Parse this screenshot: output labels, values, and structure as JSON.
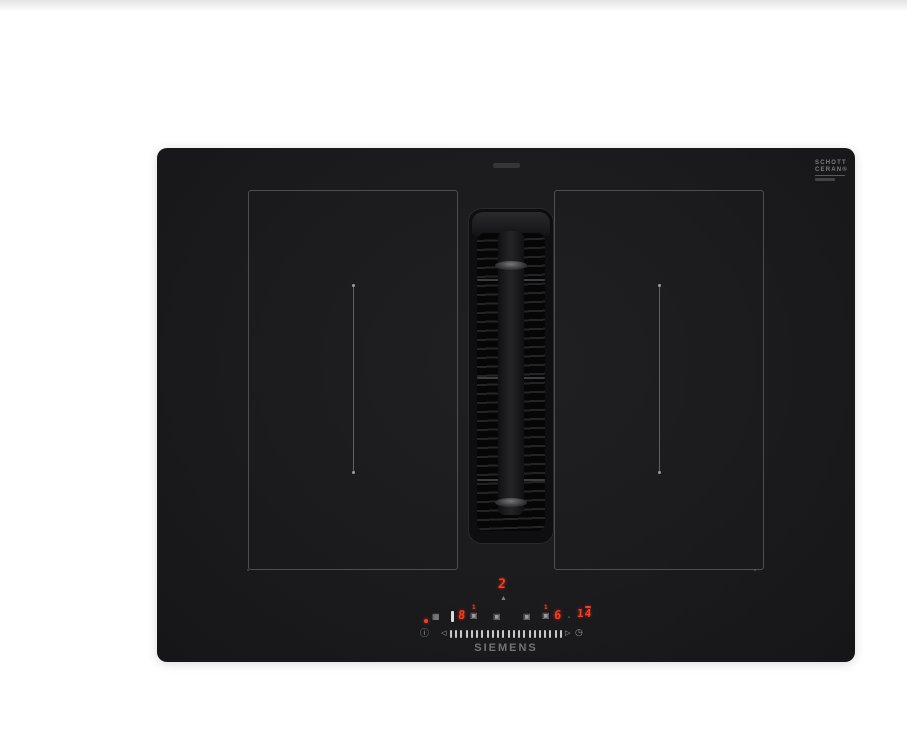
{
  "cooktop": {
    "brand": "SIEMENS",
    "body_color": "#1b1b1d",
    "led_color": "#ff3a20",
    "glass_logo": {
      "line1": "SCHOTT",
      "line2": "CERAN®"
    },
    "zone_marker": "▫"
  },
  "control_panel": {
    "fan": {
      "level": "2",
      "icon": "▲"
    },
    "power_left": "8",
    "power_right": "6",
    "timer": "14",
    "mini_indicator_left": "1",
    "mini_indicator_right": "1",
    "icons": {
      "wipe_protection": "▦",
      "zone_select_a": "▣",
      "zone_select_b": "▣",
      "zone_select_c": "▣",
      "stack_base_left": "▣",
      "stack_base_right": "▣",
      "tiny_square": "▫",
      "info": "ⓘ",
      "clock": "◷",
      "left_arrow": "◁",
      "right_arrow": "▷"
    },
    "slider": {
      "tick_count": 22
    }
  }
}
